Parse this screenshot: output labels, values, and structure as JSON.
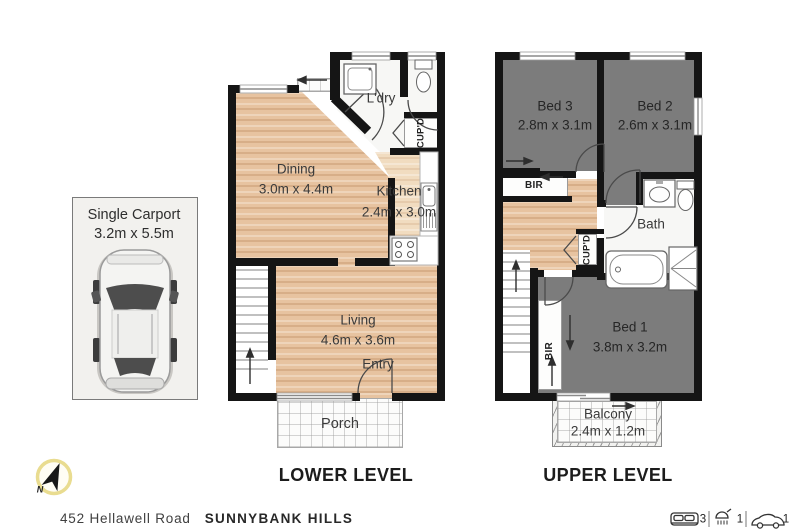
{
  "address": {
    "street": "452 Hellawell Road",
    "suburb": "SUNNYBANK HILLS"
  },
  "levels": {
    "lower": "LOWER LEVEL",
    "upper": "UPPER LEVEL"
  },
  "carport": {
    "name": "Single Carport",
    "dims": "3.2m x 5.5m"
  },
  "rooms": {
    "dining": {
      "name": "Dining",
      "dims": "3.0m x 4.4m"
    },
    "kitchen": {
      "name": "Kitchen",
      "dims": "2.4m x 3.0m"
    },
    "living": {
      "name": "Living",
      "dims": "4.6m x 3.6m"
    },
    "ldry": {
      "name": "L'dry"
    },
    "entry": {
      "name": "Entry"
    },
    "porch": {
      "name": "Porch"
    },
    "bed1": {
      "name": "Bed 1",
      "dims": "3.8m x 3.2m"
    },
    "bed2": {
      "name": "Bed 2",
      "dims": "2.6m x 3.1m"
    },
    "bed3": {
      "name": "Bed 3",
      "dims": "2.8m x 3.1m"
    },
    "bath": {
      "name": "Bath"
    },
    "balcony": {
      "name": "Balcony",
      "dims": "2.4m x 1.2m"
    },
    "bir": "BIR",
    "cupd": "CUP'D"
  },
  "compass": {
    "label": "N"
  },
  "summary": {
    "beds": "3",
    "baths": "1",
    "cars": "1"
  },
  "icons": [
    "north-compass-icon",
    "bed-icon",
    "shower-icon",
    "car-icon",
    "car-top-view",
    "stove-icon",
    "sink-icon",
    "laundry-tub-icon",
    "toilet-icon",
    "vanity-icon",
    "bathtub-icon",
    "shower-cubicle-icon",
    "stairs",
    "door-arc"
  ],
  "colors": {
    "wall": "#151515",
    "wood": "#e7c3a0",
    "wood_light": "#f1dcc0",
    "bedroom_gray": "#7c7c7c",
    "carport_bg": "#f2f1ee",
    "compass_ring": "#e9dc90"
  }
}
